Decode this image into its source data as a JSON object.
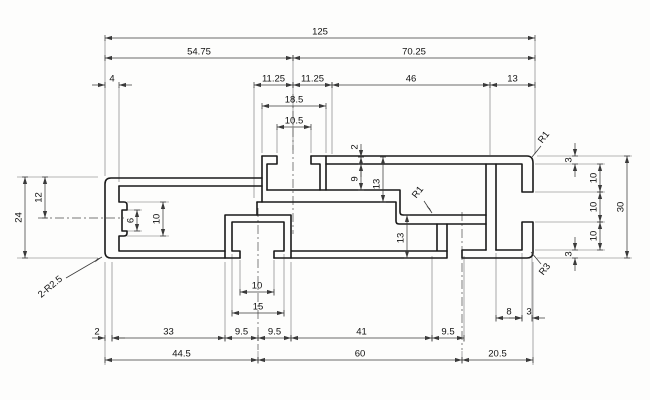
{
  "drawing": {
    "type": "technical-profile-cross-section",
    "colors": {
      "background": "#fdfdfc",
      "profile_line": "#1a1a1a",
      "dim_line": "#3a3a3a",
      "ext_line": "#6f6f6f",
      "center_line": "#4a4a4a",
      "text": "#111111"
    },
    "h_dims": [
      {
        "v": "125",
        "x1": 105,
        "x2": 535,
        "y": 38
      },
      {
        "v": "54.75",
        "x1": 105,
        "x2": 293,
        "y": 58
      },
      {
        "v": "70.25",
        "x1": 293,
        "x2": 535,
        "y": 58
      },
      {
        "v": "4",
        "x1": 105,
        "x2": 119,
        "y": 85,
        "lx": 112,
        "out": true
      },
      {
        "v": "11.25",
        "x1": 254,
        "x2": 293,
        "y": 85
      },
      {
        "v": "11.25",
        "x1": 293,
        "x2": 332,
        "y": 85
      },
      {
        "v": "46",
        "x1": 332,
        "x2": 490,
        "y": 85
      },
      {
        "v": "13",
        "x1": 490,
        "x2": 535,
        "y": 85
      },
      {
        "v": "18.5",
        "x1": 262,
        "x2": 326,
        "y": 106
      },
      {
        "v": "10.5",
        "x1": 277,
        "x2": 311,
        "y": 127
      },
      {
        "v": "10",
        "x1": 240,
        "x2": 274,
        "y": 292
      },
      {
        "v": "15",
        "x1": 232,
        "x2": 284,
        "y": 313
      },
      {
        "v": "8",
        "x1": 496,
        "x2": 522,
        "y": 318
      },
      {
        "v": "3",
        "x1": 522,
        "x2": 532,
        "y": 318,
        "lx": 529,
        "out": true
      },
      {
        "v": "2",
        "x1": 105,
        "x2": 112,
        "y": 338,
        "lx": 97,
        "out": true
      },
      {
        "v": "33",
        "x1": 112,
        "x2": 225,
        "y": 338
      },
      {
        "v": "9.5",
        "x1": 225,
        "x2": 258,
        "y": 338
      },
      {
        "v": "9.5",
        "x1": 258,
        "x2": 291,
        "y": 338
      },
      {
        "v": "41",
        "x1": 291,
        "x2": 432,
        "y": 338
      },
      {
        "v": "9.5",
        "x1": 432,
        "x2": 464,
        "y": 338
      },
      {
        "v": "44.5",
        "x1": 105,
        "x2": 258,
        "y": 360
      },
      {
        "v": "60",
        "x1": 258,
        "x2": 462,
        "y": 360
      },
      {
        "v": "20.5",
        "x1": 462,
        "x2": 533,
        "y": 360
      }
    ],
    "v_dims": [
      {
        "v": "24",
        "y1": 177,
        "y2": 258,
        "x": 25
      },
      {
        "v": "12",
        "y1": 177,
        "y2": 218,
        "x": 45
      },
      {
        "v": "6",
        "y1": 210,
        "y2": 231,
        "x": 137
      },
      {
        "v": "10",
        "y1": 202,
        "y2": 236,
        "x": 163
      },
      {
        "v": "2",
        "y1": 157,
        "y2": 164,
        "x": 361,
        "ly": 147,
        "out": true
      },
      {
        "v": "9",
        "y1": 157,
        "y2": 190,
        "x": 361,
        "ly": 179
      },
      {
        "v": "13",
        "y1": 157,
        "y2": 202,
        "x": 383,
        "ly": 184
      },
      {
        "v": "13",
        "y1": 215,
        "y2": 258,
        "x": 407,
        "ly": 238
      },
      {
        "v": "3",
        "y1": 156,
        "y2": 164,
        "x": 575,
        "ly": 160,
        "out": true
      },
      {
        "v": "10",
        "y1": 164,
        "y2": 192,
        "x": 600
      },
      {
        "v": "10",
        "y1": 192,
        "y2": 222,
        "x": 600
      },
      {
        "v": "10",
        "y1": 222,
        "y2": 250,
        "x": 600
      },
      {
        "v": "3",
        "y1": 250,
        "y2": 258,
        "x": 575,
        "ly": 254,
        "out": true
      },
      {
        "v": "30",
        "y1": 156,
        "y2": 258,
        "x": 627
      }
    ],
    "r_labels": [
      {
        "v": "R1",
        "x": 546,
        "y": 139,
        "rot": -52,
        "leader": [
          541,
          146,
          532,
          157
        ]
      },
      {
        "v": "R1",
        "x": 420,
        "y": 194,
        "rot": -52,
        "leader": [
          424,
          201,
          432,
          213
        ]
      },
      {
        "v": "R3",
        "x": 547,
        "y": 271,
        "rot": -52,
        "leader": [
          541,
          264,
          531,
          252
        ]
      },
      {
        "v": "2-R2.5",
        "x": 52,
        "y": 289,
        "rot": -40,
        "leader": [
          66,
          278,
          102,
          257
        ]
      }
    ]
  }
}
